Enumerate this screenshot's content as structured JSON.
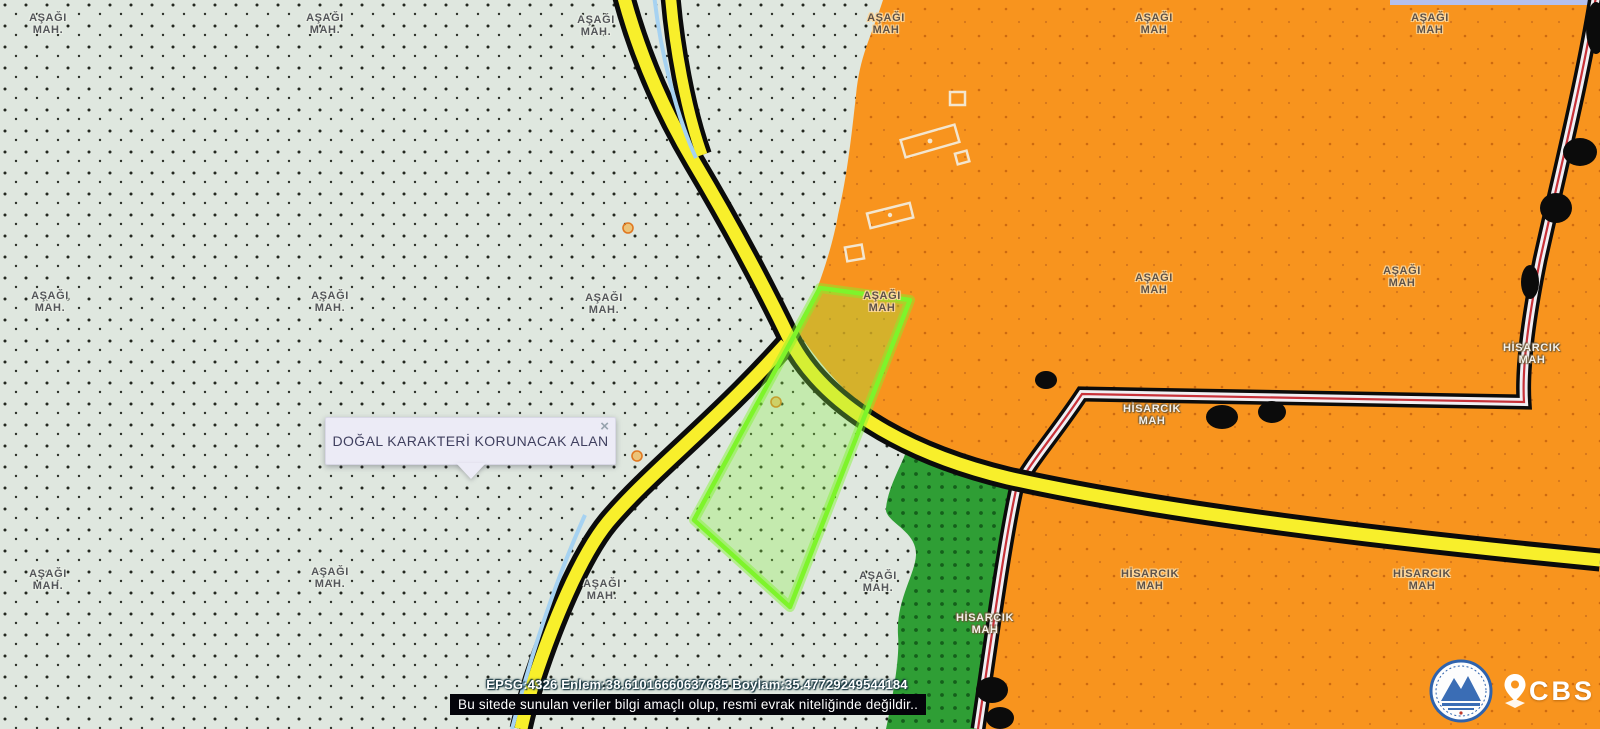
{
  "app": {
    "name": "CBS belediye harita görüntüleyici"
  },
  "popup": {
    "text": "DOĞAL KARAKTERİ KORUNACAK ALAN",
    "close_glyph": "×"
  },
  "statusbar": {
    "coordinates": "EPSG:4326 Enlem:38.61016660637685 Boylam:35.47729249544184"
  },
  "disclaimer": {
    "text": "Bu sitede sunulan veriler bilgi amaçlı olup, resmi evrak niteliğinde değildir.."
  },
  "branding": {
    "cbs_label": "CBS",
    "logo": "kayseri-buyuksehir-belediyesi-ambleml"
  },
  "legend_colors": {
    "zone_sage": "#dfe7df",
    "zone_orange": "#f8941e",
    "zone_green": "#2f9e35",
    "road_yellow": "#f8ef2b",
    "road_casing": "#0b0b0b",
    "highway_fill": "#f1eff3",
    "highway_red_line": "#c8323a",
    "stream_blue": "#a6d2f1",
    "parcel_highlight": "#7ef42b",
    "popup_bg": "#ecebf6"
  },
  "map_labels": [
    {
      "l1": "AŞAĞI",
      "l2": "MAH."
    },
    {
      "l1": "AŞAĞI",
      "l2": "MAH."
    },
    {
      "l1": "AŞAĞI",
      "l2": "MAH."
    },
    {
      "l1": "AŞAĞI",
      "l2": "MAH"
    },
    {
      "l1": "AŞAĞI",
      "l2": "MAH"
    },
    {
      "l1": "AŞAĞI",
      "l2": "MAH"
    },
    {
      "l1": "AŞAĞI",
      "l2": "MAH."
    },
    {
      "l1": "AŞAĞI",
      "l2": "MAH."
    },
    {
      "l1": "AŞAĞI",
      "l2": "MAH."
    },
    {
      "l1": "AŞAĞI",
      "l2": "MAH"
    },
    {
      "l1": "AŞAĞI",
      "l2": "MAH"
    },
    {
      "l1": "AŞAĞI",
      "l2": "MAH"
    },
    {
      "l1": "HİSARCIK",
      "l2": "MAH"
    },
    {
      "l1": "HİSARCIK",
      "l2": "MAH"
    },
    {
      "l1": "AŞAĞI",
      "l2": "MAH."
    },
    {
      "l1": "AŞAĞI",
      "l2": "MAH."
    },
    {
      "l1": "AŞAĞI",
      "l2": "MAH."
    },
    {
      "l1": "AŞAĞI",
      "l2": "MAH."
    },
    {
      "l1": "HİSARCIK",
      "l2": "MAH"
    },
    {
      "l1": "HİSARCIK",
      "l2": "MAH"
    },
    {
      "l1": "HİSARCIK",
      "l2": "MAH"
    }
  ]
}
